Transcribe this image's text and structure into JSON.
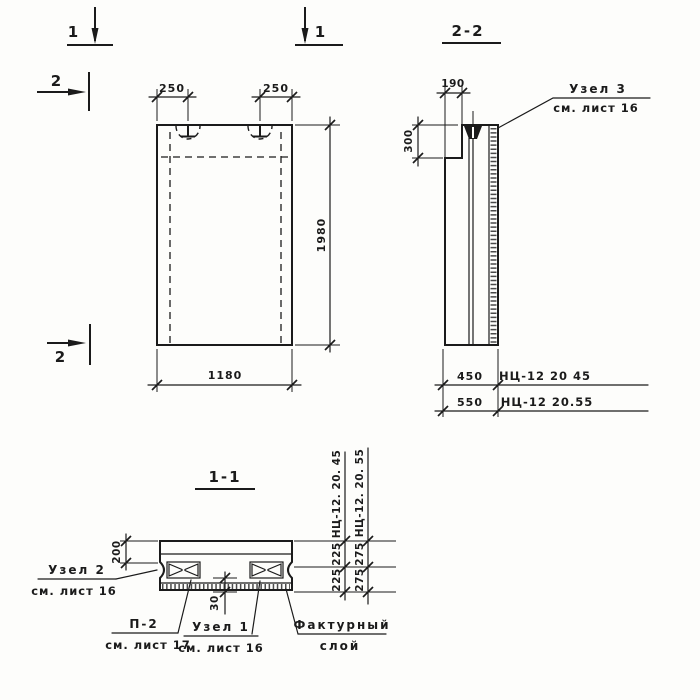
{
  "meta": {
    "background": "#fdfdfb",
    "ink": "#1b1b1b"
  },
  "markers": {
    "cut1_left": "1",
    "cut1_right": "1",
    "cut2_top": "2",
    "cut2_bottom": "2"
  },
  "front_view": {
    "dim_loop_left": "250",
    "dim_loop_right": "250",
    "dim_height": "1980",
    "dim_width": "1180"
  },
  "section22": {
    "title": "2-2",
    "dim_ledge_depth": "190",
    "dim_ledge_height": "300",
    "dim_thick_1": "450",
    "mark_1": "НЦ-12 20 45",
    "dim_thick_2": "550",
    "mark_2": "НЦ-12 20.55",
    "node3_title": "Узел 3",
    "node3_ref": "см. лист 16"
  },
  "section11": {
    "title": "1-1",
    "dim_edge": "200",
    "dim_layer": "30",
    "col45_header": "НЦ-12. 20. 45",
    "col45_seg1": "225",
    "col45_seg2": "225",
    "col55_header": "НЦ-12. 20. 55",
    "col55_seg1": "275",
    "col55_seg2": "275",
    "node2_title": "Узел 2",
    "node2_ref": "см. лист 16",
    "p2_title": "П-2",
    "p2_ref": "см. лист 17",
    "node1_title": "Узел 1",
    "node1_ref": "см. лист 16",
    "facture_line1": "Фактурный",
    "facture_line2": "слой"
  }
}
